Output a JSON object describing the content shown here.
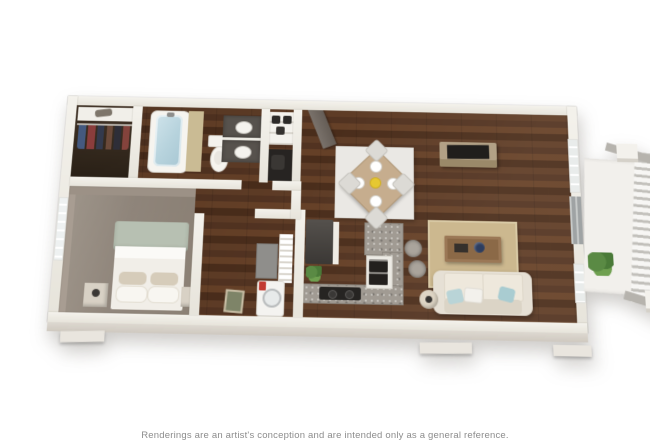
{
  "page": {
    "background_color": "#ffffff",
    "caption": "Renderings are an artist's conception and are intended only as a general reference."
  },
  "floor_plan": {
    "view": "3D top-down rendering of a one-bedroom apartment, slightly rotated with perspective",
    "rooms": [
      {
        "name": "walk-in closet",
        "contents": [
          "shelf with item",
          "rod with hanging clothes"
        ]
      },
      {
        "name": "bathroom",
        "contents": [
          "bathtub with glass",
          "tan tub side panel",
          "toilet",
          "double vanity with two sinks"
        ]
      },
      {
        "name": "entry",
        "contents": [
          "open door",
          "shoe shelves",
          "dark storage cubby"
        ]
      },
      {
        "name": "bedroom",
        "contents": [
          "bed with sage headboard",
          "white bedding and pillows",
          "two nightstands",
          "paned window",
          "leaning picture frame"
        ]
      },
      {
        "name": "laundry closet",
        "contents": [
          "washer with red detergent",
          "wire shelving",
          "gray cabinet"
        ]
      },
      {
        "name": "kitchen",
        "contents": [
          "dark refrigerator",
          "granite counters",
          "two-burner cooktop",
          "stacked wall ovens",
          "granite breakfast-bar island",
          "two bar stools",
          "potted plant"
        ]
      },
      {
        "name": "dining area",
        "contents": [
          "square wood table rotated 45 degrees",
          "four white place settings",
          "yellow centerpiece",
          "four light chairs",
          "light area rug"
        ]
      },
      {
        "name": "living room",
        "contents": [
          "cream sofa with blue and white throw pillows",
          "wood coffee table with navy bowl and books",
          "tan area rug",
          "media console with TV",
          "round side table with lamp"
        ]
      },
      {
        "name": "balcony",
        "contents": [
          "concrete slab",
          "slat railing",
          "two white posts",
          "green plant"
        ]
      }
    ],
    "colors": {
      "walls": "#edebe4",
      "wood_floor": "#57371f",
      "bedroom_carpet": "#9a8f84",
      "living_rug": "#ccb88f",
      "dining_rug": "#eae8e4",
      "sofa": "#e6e0d5",
      "accent_pillows": "#b9d4d7",
      "dining_table": "#c6ad8e",
      "granite": "#a19b93",
      "tub_glass": "#b7d3dd",
      "bed_headboard": "#b7c0b2",
      "plant": "#5a8a44",
      "caption_text": "#8c8c8c"
    }
  }
}
